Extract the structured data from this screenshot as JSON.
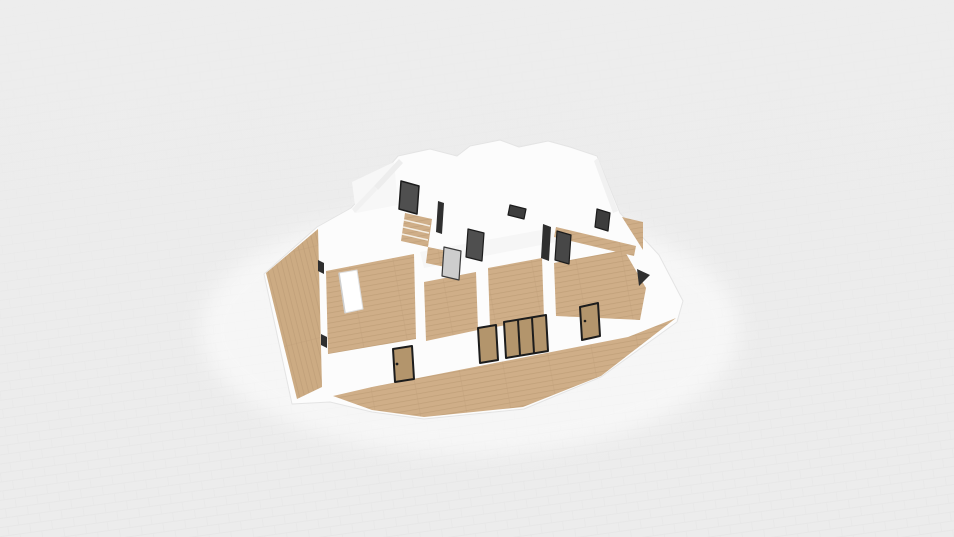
{
  "viewport": {
    "width": 954,
    "height": 537,
    "background": "#ececec"
  },
  "palette": {
    "bg": "#ececec",
    "grid": "#e1e1e1",
    "platform": "#fcfcfc",
    "platformEdge": "#e4e4e4",
    "wood": "#cfae88",
    "woodLine": "#bd9d76",
    "deckWood": "#ccab83",
    "island": "#ffffff",
    "islandEdge": "#dedede",
    "corridor": "#f6f6f6",
    "whiteFloor": "#f7f7f7",
    "wallFace": "#ededed",
    "wallFaceLight": "#f1f1f1",
    "darkDoor": "#4f4f4f",
    "darkDoor2": "#474747",
    "darkDoor3": "#3d3d3d",
    "grayDoor": "#cdcdcd",
    "tanDoor": "#b3956c",
    "doorFrame": "#1c1c1c",
    "accent": "#2f2f2f",
    "tread": "#f4ede2",
    "pool": "#ffffff"
  },
  "scene": {
    "shapes": [
      {
        "name": "ground-light-pool",
        "type": "ellipse",
        "cx": 470,
        "cy": 330,
        "rx": 270,
        "ry": 125,
        "fill": "pool",
        "opacity": 0.55,
        "filter": "softBlur"
      },
      {
        "name": "house-platform",
        "type": "polygon",
        "fill": "platform",
        "stroke": "platformEdge",
        "sw": 1,
        "pts": "264,274 317,227 351,208 374,184 398,156 430,149 457,156 470,146 500,140 519,147 548,141 570,147 597,156 620,213 659,255 683,301 677,322 601,377 524,409 424,419 372,412 330,402 292,404"
      },
      {
        "name": "left-deck-floor",
        "type": "polygon",
        "fill": "@plankB",
        "pts": "266,273 318,229 322,387 297,399"
      },
      {
        "name": "front-terrace-floor",
        "type": "polygon",
        "fill": "@plankA",
        "pts": "333,396 372,387 628,337 676,318 601,376 523,407 424,417 372,410"
      },
      {
        "name": "living-room-floor",
        "type": "polygon",
        "fill": "@plankA",
        "pts": "326,271 414,254 416,339 328,354"
      },
      {
        "name": "room-a-floor",
        "type": "polygon",
        "fill": "@plankA",
        "pts": "424,282 476,272 478,330 426,341"
      },
      {
        "name": "room-b-floor",
        "type": "polygon",
        "fill": "@plankA",
        "pts": "488,268 542,258 544,318 490,328"
      },
      {
        "name": "room-c-floor",
        "type": "polygon",
        "fill": "@plankA",
        "pts": "554,263 624,250 646,288 640,320 556,316"
      },
      {
        "name": "corridor-floor",
        "type": "polygon",
        "fill": "corridor",
        "pts": "420,252 552,228 556,242 424,268"
      },
      {
        "name": "top-left-room-floor",
        "type": "polygon",
        "fill": "whiteFloor",
        "pts": "352,182 394,162 398,205 356,213"
      },
      {
        "name": "hallway-wood-strip",
        "type": "polygon",
        "fill": "@plankA",
        "pts": "556,227 636,246 634,256 554,237"
      },
      {
        "name": "right-wood-wedge",
        "type": "polygon",
        "fill": "@plankA",
        "pts": "622,217 643,222 643,250"
      },
      {
        "name": "wall-face-shade-1",
        "type": "polygon",
        "fill": "wallFace",
        "pts": "374,186 399,159 403,163 378,190"
      },
      {
        "name": "wall-face-shade-2",
        "type": "polygon",
        "fill": "wallFaceLight",
        "pts": "352,209 374,186 377,190 355,213"
      },
      {
        "name": "wall-face-shade-3",
        "type": "polygon",
        "fill": "wallFaceLight",
        "pts": "598,158 618,211 613,213 594,161"
      },
      {
        "name": "staircase-steps",
        "type": "polygon",
        "fill": "@plankA",
        "pts": "405,213 432,219 428,247 401,241"
      },
      {
        "name": "stair-tread-1",
        "type": "line",
        "x1": 404,
        "y1": 220,
        "x2": 430,
        "y2": 226,
        "stroke": "tread",
        "sw": 1.6
      },
      {
        "name": "stair-tread-2",
        "type": "line",
        "x1": 403,
        "y1": 227,
        "x2": 429,
        "y2": 233,
        "stroke": "tread",
        "sw": 1.6
      },
      {
        "name": "stair-tread-3",
        "type": "line",
        "x1": 402,
        "y1": 234,
        "x2": 428,
        "y2": 240,
        "stroke": "tread",
        "sw": 1.6
      },
      {
        "name": "stair-landing",
        "type": "polygon",
        "fill": "@plankA",
        "pts": "428,247 452,252 450,268 426,263"
      },
      {
        "name": "kitchen-island",
        "type": "polygon",
        "fill": "island",
        "stroke": "islandEdge",
        "sw": 1,
        "pts": "339,273 357,270 363,309 345,313"
      },
      {
        "name": "island-shadow-edge",
        "type": "line",
        "x1": 339,
        "y1": 273,
        "x2": 345,
        "y2": 313,
        "stroke": "#cfcfcf",
        "sw": 1.5
      },
      {
        "name": "doorway-shadow-left-top",
        "type": "polygon",
        "fill": "accent",
        "pts": "318,260 324,263 324,274 318,271"
      },
      {
        "name": "doorway-shadow-left-bottom",
        "type": "polygon",
        "fill": "accent",
        "pts": "321,334 327,337 327,348 321,345"
      },
      {
        "name": "doorway-shadow-stair",
        "type": "polygon",
        "fill": "accent",
        "pts": "438,201 444,203 442,234 436,232"
      },
      {
        "name": "doorway-shadow-center",
        "type": "polygon",
        "fill": "accent",
        "pts": "543,224 551,227 549,261 541,258"
      },
      {
        "name": "doorway-shadow-right",
        "type": "polygon",
        "fill": "accent",
        "pts": "637,269 650,275 639,286"
      },
      {
        "name": "door-panel-top-center",
        "type": "polygon",
        "fill": "darkDoor3",
        "stroke": "doorFrame",
        "sw": 1.2,
        "pts": "510,205 526,209 524,219 508,215"
      },
      {
        "name": "stair-door-panel",
        "type": "polygon",
        "fill": "darkDoor",
        "stroke": "doorFrame",
        "sw": 1.5,
        "pts": "401,181 419,186 417,214 399,209"
      },
      {
        "name": "gray-door-panel",
        "type": "polygon",
        "fill": "grayDoor",
        "stroke": "#3a3a3a",
        "sw": 1.2,
        "pts": "444,247 461,251 459,280 442,276"
      },
      {
        "name": "dark-door-panel-1",
        "type": "polygon",
        "fill": "darkDoor",
        "stroke": "doorFrame",
        "sw": 1.2,
        "pts": "468,229 484,233 482,261 466,257"
      },
      {
        "name": "dark-door-panel-2",
        "type": "polygon",
        "fill": "darkDoor2",
        "stroke": "doorFrame",
        "sw": 1.2,
        "pts": "557,231 571,235 569,264 555,260"
      },
      {
        "name": "dark-door-panel-3",
        "type": "polygon",
        "fill": "darkDoor3",
        "stroke": "doorFrame",
        "sw": 1.2,
        "pts": "597,209 610,213 608,231 595,227"
      },
      {
        "name": "front-entry-door",
        "type": "polygon",
        "fill": "tanDoor",
        "stroke": "doorFrame",
        "sw": 2,
        "pts": "393,349 412,346 414,379 395,382"
      },
      {
        "name": "front-glass-door-1",
        "type": "polygon",
        "fill": "tanDoor",
        "stroke": "doorFrame",
        "sw": 2,
        "pts": "478,328 496,325 498,360 480,363"
      },
      {
        "name": "front-sliding-glass-door",
        "type": "polygon",
        "fill": "tanDoor",
        "stroke": "doorFrame",
        "sw": 2,
        "pts": "504,322 546,315 548,351 506,358"
      },
      {
        "name": "slider-mullion-1",
        "type": "line",
        "x1": 518,
        "y1": 320,
        "x2": 520,
        "y2": 355,
        "stroke": "doorFrame",
        "sw": 2
      },
      {
        "name": "slider-mullion-2",
        "type": "line",
        "x1": 532,
        "y1": 318,
        "x2": 534,
        "y2": 353,
        "stroke": "doorFrame",
        "sw": 2
      },
      {
        "name": "front-door-right",
        "type": "polygon",
        "fill": "tanDoor",
        "stroke": "doorFrame",
        "sw": 2,
        "pts": "580,307 598,303 600,336 582,340"
      },
      {
        "name": "entry-door-handle",
        "type": "ellipse",
        "cx": 397,
        "cy": 364,
        "rx": 1.4,
        "ry": 1.4,
        "fill": "doorFrame",
        "opacity": 1
      },
      {
        "name": "right-door-handle",
        "type": "ellipse",
        "cx": 585,
        "cy": 321,
        "rx": 1.3,
        "ry": 1.3,
        "fill": "doorFrame",
        "opacity": 1
      }
    ]
  }
}
